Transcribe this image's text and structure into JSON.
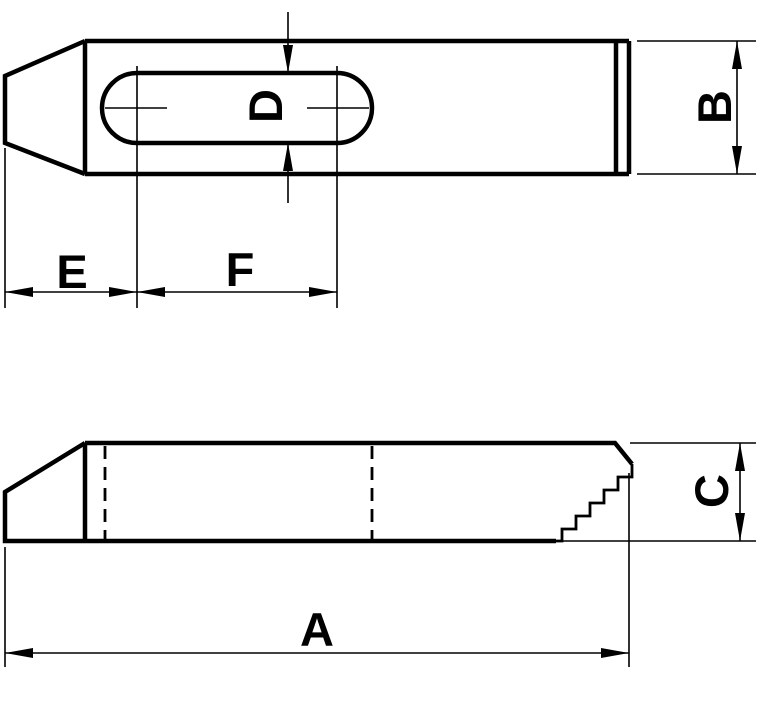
{
  "colors": {
    "ink": "#000000",
    "paper": "#ffffff"
  },
  "plan_view": {
    "dim_slot_width_label": "D",
    "dim_bar_width_label": "B",
    "dim_tip_to_slot_label": "E",
    "dim_slot_length_label": "F"
  },
  "side_view": {
    "dim_total_length_label": "A",
    "dim_bar_height_label": "C"
  }
}
